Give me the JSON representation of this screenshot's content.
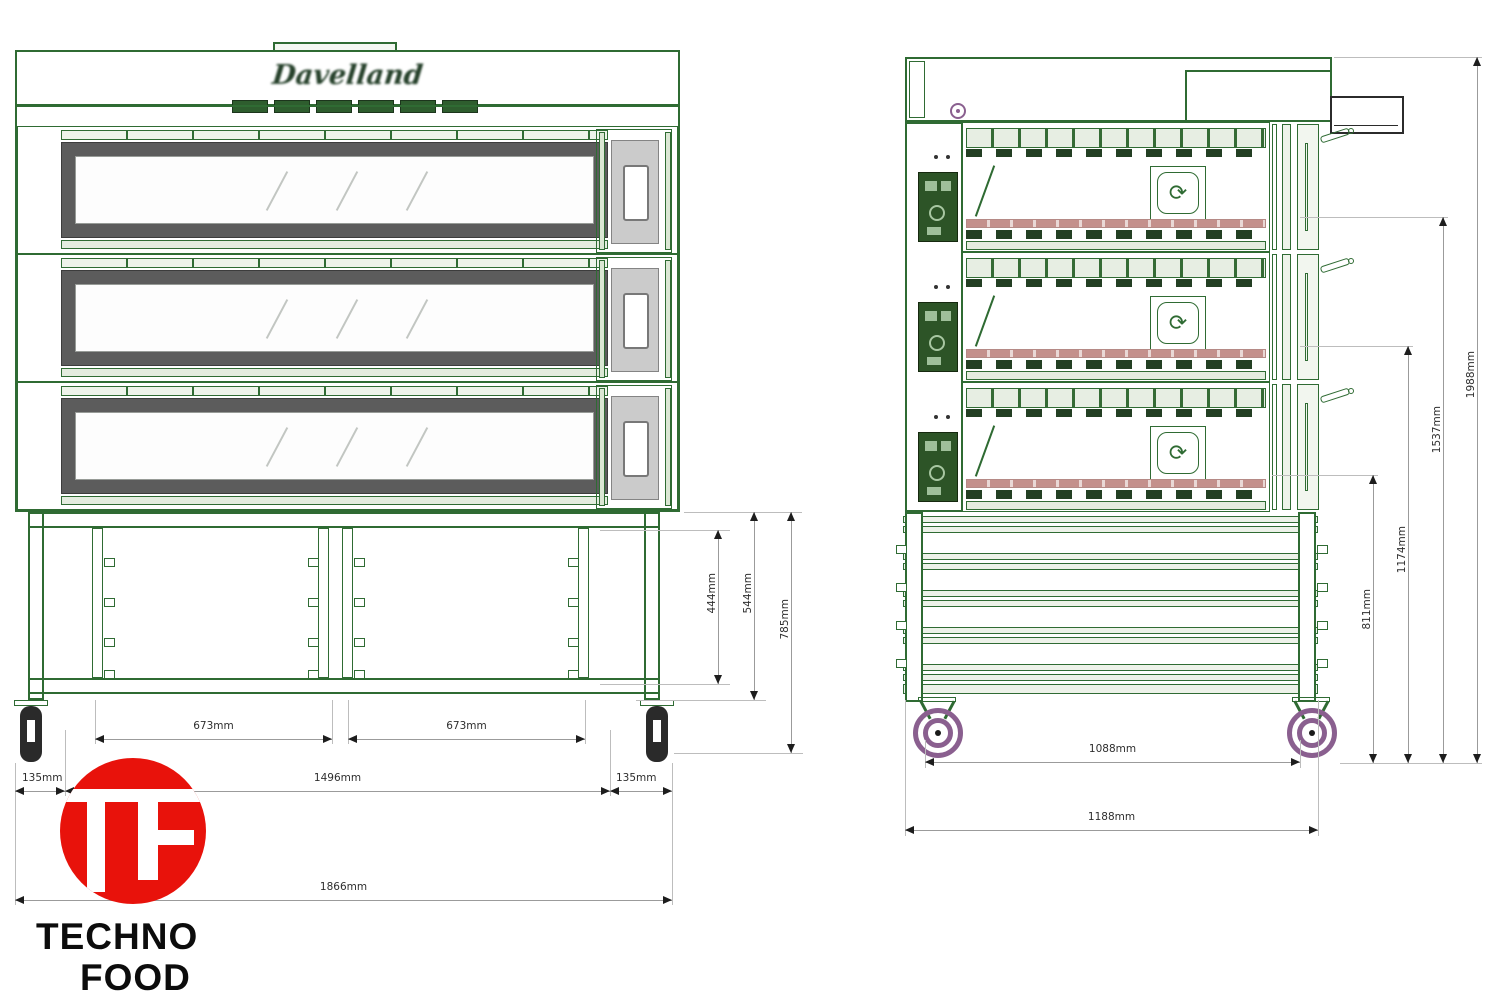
{
  "brand": {
    "logo_text": "Davelland"
  },
  "front_view": {
    "dims": {
      "shelf_left": "673mm",
      "shelf_right": "673mm",
      "left_offset": "135mm",
      "inner_width": "1496mm",
      "right_offset": "135mm",
      "total_width": "1866mm",
      "stand_clear_height": "444mm",
      "stand_frame_height": "544mm",
      "stand_total_height": "785mm"
    }
  },
  "side_view": {
    "dims": {
      "caster_spacing": "1088mm",
      "total_depth": "1188mm",
      "h_stand": "811mm",
      "h_two_decks": "1174mm",
      "h_three_decks": "1537mm",
      "h_total": "1988mm"
    }
  },
  "logo": {
    "monogram": "TF",
    "line1": "TECHNO",
    "line2": "FOOD"
  },
  "icons": {
    "fan_glyph": "⟳"
  },
  "colors": {
    "line_green": "#2f6b33",
    "panel_green": "#2d5427",
    "door_gray": "#5c5c5c",
    "stone_pink": "#c4908c",
    "wheel_purple": "#8a5f8f",
    "logo_red": "#e8120b",
    "dim_gray": "#9b9b9b"
  }
}
